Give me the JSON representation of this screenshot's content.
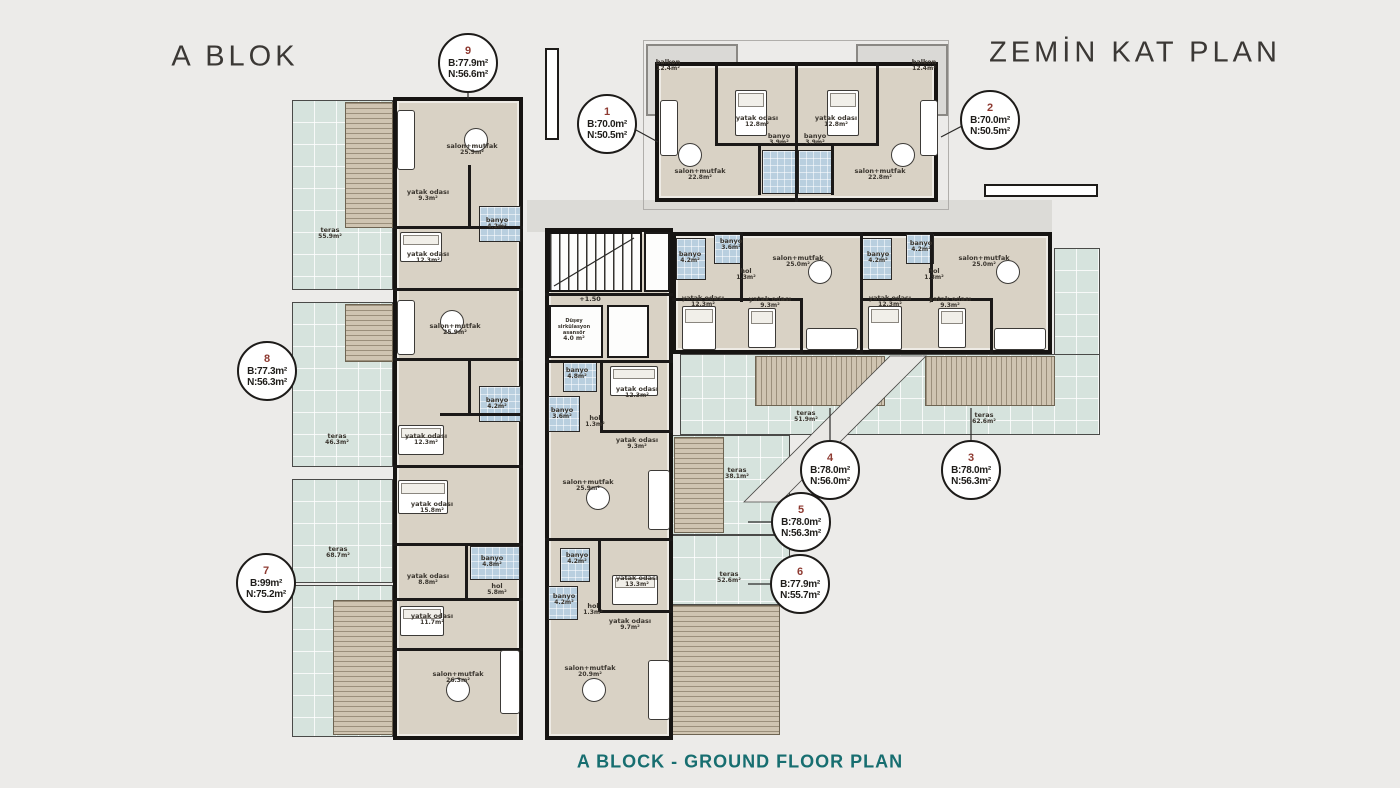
{
  "header": {
    "left_title": "A BLOK",
    "right_title": "ZEMİN KAT PLAN"
  },
  "caption": "A BLOCK - GROUND FLOOR PLAN",
  "level_marker": "+1.50",
  "colors": {
    "accent_caption": "#176e70",
    "unit_number": "#8e3a31",
    "terrace": "#d6e3dd",
    "wood_deck": "#cfc4b1",
    "bathroom": "#b9cfdf",
    "building_floor": "#d9d2c5",
    "walls": "#161412",
    "background": "#ecebe9"
  },
  "units": [
    {
      "no": "1",
      "brut": "B:70.0m²",
      "net": "N:50.5m²"
    },
    {
      "no": "2",
      "brut": "B:70.0m²",
      "net": "N:50.5m²"
    },
    {
      "no": "3",
      "brut": "B:78.0m²",
      "net": "N:56.3m²"
    },
    {
      "no": "4",
      "brut": "B:78.0m²",
      "net": "N:56.0m²"
    },
    {
      "no": "5",
      "brut": "B:78.0m²",
      "net": "N:56.3m²"
    },
    {
      "no": "6",
      "brut": "B:77.9m²",
      "net": "N:55.7m²"
    },
    {
      "no": "7",
      "brut": "B:99m²",
      "net": "N:75.2m²"
    },
    {
      "no": "8",
      "brut": "B:77.3m²",
      "net": "N:56.3m²"
    },
    {
      "no": "9",
      "brut": "B:77.9m²",
      "net": "N:56.6m²"
    }
  ],
  "rooms": [
    {
      "id": "L1",
      "name": "salon+mutfak",
      "area": "25.9m²"
    },
    {
      "id": "L2",
      "name": "yatak odası",
      "area": "9.3m²"
    },
    {
      "id": "L3",
      "name": "banyo",
      "area": "4.2m²"
    },
    {
      "id": "L4",
      "name": "yatak odası",
      "area": "12.3m²"
    },
    {
      "id": "L5",
      "name": "salon+mutfak",
      "area": "25.9m²"
    },
    {
      "id": "L6",
      "name": "banyo",
      "area": "4.2m²"
    },
    {
      "id": "L7",
      "name": "yatak odası",
      "area": "12.3m²"
    },
    {
      "id": "L8",
      "name": "yatak odası",
      "area": "15.8m²"
    },
    {
      "id": "L9",
      "name": "banyo",
      "area": "4.8m²"
    },
    {
      "id": "L10",
      "name": "yatak odası",
      "area": "8.8m²"
    },
    {
      "id": "L11",
      "name": "hol",
      "area": "5.8m²"
    },
    {
      "id": "L12",
      "name": "yatak odası",
      "area": "11.7m²"
    },
    {
      "id": "L13",
      "name": "salon+mutfak",
      "area": "26.3m²"
    },
    {
      "id": "M1",
      "name": "Düşey sirkülasyon asansör",
      "area": "4.0 m²"
    },
    {
      "id": "M2",
      "name": "banyo",
      "area": "4.8m²"
    },
    {
      "id": "M3",
      "name": "banyo",
      "area": "3.6m²"
    },
    {
      "id": "M4",
      "name": "yatak odası",
      "area": "12.3m²"
    },
    {
      "id": "M5",
      "name": "hol",
      "area": "1.3m²"
    },
    {
      "id": "M6",
      "name": "yatak odası",
      "area": "9.3m²"
    },
    {
      "id": "M7",
      "name": "salon+mutfak",
      "area": "25.9m²"
    },
    {
      "id": "M8",
      "name": "banyo",
      "area": "4.2m²"
    },
    {
      "id": "M9",
      "name": "yatak odası",
      "area": "13.3m²"
    },
    {
      "id": "M10",
      "name": "banyo",
      "area": "4.2m²"
    },
    {
      "id": "M11",
      "name": "hol",
      "area": "1.3m²"
    },
    {
      "id": "M12",
      "name": "yatak odası",
      "area": "9.7m²"
    },
    {
      "id": "M13",
      "name": "salon+mutfak",
      "area": "20.9m²"
    },
    {
      "id": "T1",
      "name": "balkon",
      "area": "12.4m²"
    },
    {
      "id": "T2",
      "name": "balkon",
      "area": "12.4m²"
    },
    {
      "id": "T3",
      "name": "yatak odası",
      "area": "12.8m²"
    },
    {
      "id": "T4",
      "name": "yatak odası",
      "area": "12.8m²"
    },
    {
      "id": "T5",
      "name": "salon+mutfak",
      "area": "22.8m²"
    },
    {
      "id": "T6",
      "name": "salon+mutfak",
      "area": "22.8m²"
    },
    {
      "id": "T7",
      "name": "banyo",
      "area": "3.9m²"
    },
    {
      "id": "T8",
      "name": "banyo",
      "area": "3.9m²"
    },
    {
      "id": "R1",
      "name": "banyo",
      "area": "4.2m²"
    },
    {
      "id": "R2",
      "name": "banyo",
      "area": "3.6m²"
    },
    {
      "id": "R3",
      "name": "hol",
      "area": "1.3m²"
    },
    {
      "id": "R4",
      "name": "yatak odası",
      "area": "12.3m²"
    },
    {
      "id": "R5",
      "name": "yatak odası",
      "area": "9.3m²"
    },
    {
      "id": "R6",
      "name": "salon+mutfak",
      "area": "25.0m²"
    },
    {
      "id": "R7",
      "name": "banyo",
      "area": "4.2m²"
    },
    {
      "id": "R8",
      "name": "banyo",
      "area": "4.2m²"
    },
    {
      "id": "R9",
      "name": "hol",
      "area": "1.3m²"
    },
    {
      "id": "R10",
      "name": "yatak odası",
      "area": "12.3m²"
    },
    {
      "id": "R11",
      "name": "yatak odası",
      "area": "9.3m²"
    },
    {
      "id": "R12",
      "name": "salon+mutfak",
      "area": "25.0m²"
    }
  ],
  "terraces": [
    {
      "id": "TE1",
      "name": "teras",
      "area": "55.9m²"
    },
    {
      "id": "TE2",
      "name": "teras",
      "area": "46.3m²"
    },
    {
      "id": "TE3",
      "name": "teras",
      "area": "68.7m²"
    },
    {
      "id": "TE4",
      "name": "teras",
      "area": "51.9m²"
    },
    {
      "id": "TE5",
      "name": "teras",
      "area": "62.6m²"
    },
    {
      "id": "TE6",
      "name": "teras",
      "area": "38.1m²"
    },
    {
      "id": "TE7",
      "name": "teras",
      "area": "52.6m²"
    }
  ]
}
